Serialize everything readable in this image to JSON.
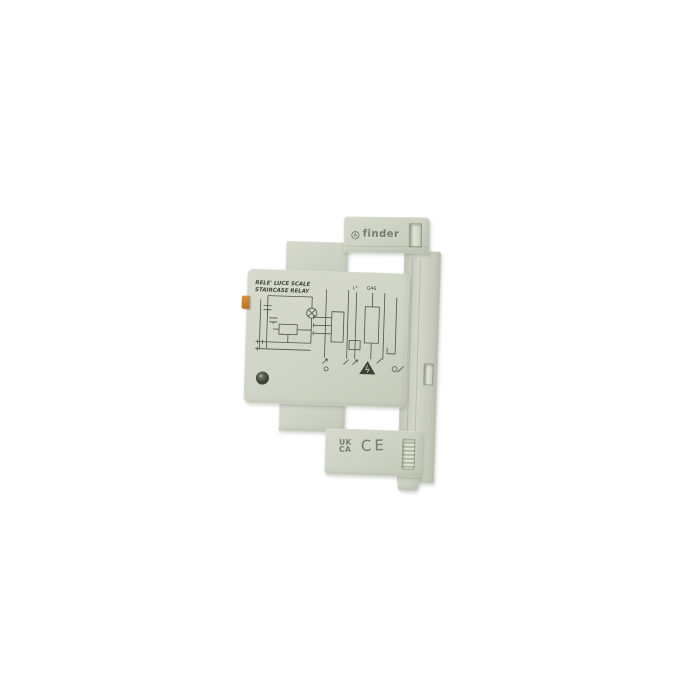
{
  "background_color": "#ffffff",
  "device": {
    "description": "finder staircase relay module, side view product photo",
    "colors": {
      "body": "#cdd1c3",
      "body_shadow": "#b6baa9",
      "label": "#d2d6c8",
      "print_line": "#50554a",
      "accent_orange": "#c07a2b",
      "background": "#ffffff"
    },
    "brand": {
      "logo_text": "finder"
    },
    "label": {
      "title_line1": "RELE' LUCE SCALE",
      "title_line2": "STAIRCASE RELAY",
      "marking_l": "L*",
      "marking_g46": "G46"
    },
    "certifications": {
      "ukca_line1": "UK",
      "ukca_line2": "CA",
      "ce": "CE"
    }
  }
}
